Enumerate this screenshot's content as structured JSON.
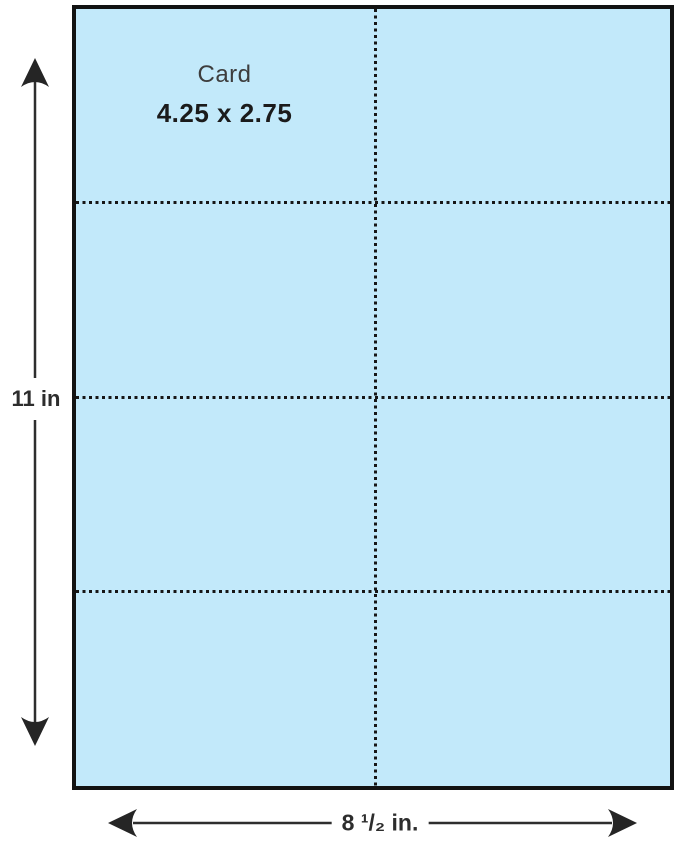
{
  "canvas": {
    "background": "#ffffff"
  },
  "sheet": {
    "fill": "#c2e9fa",
    "border_color": "#121212",
    "cut_line_color": "#161616",
    "columns": 2,
    "rows": 4,
    "label": {
      "name": "Card",
      "size": "4.25 x 2.75"
    }
  },
  "dimensions": {
    "line_color": "#2e2e2e",
    "height": {
      "label": "11 in"
    },
    "width": {
      "label": "8 ¹/₂ in."
    }
  }
}
